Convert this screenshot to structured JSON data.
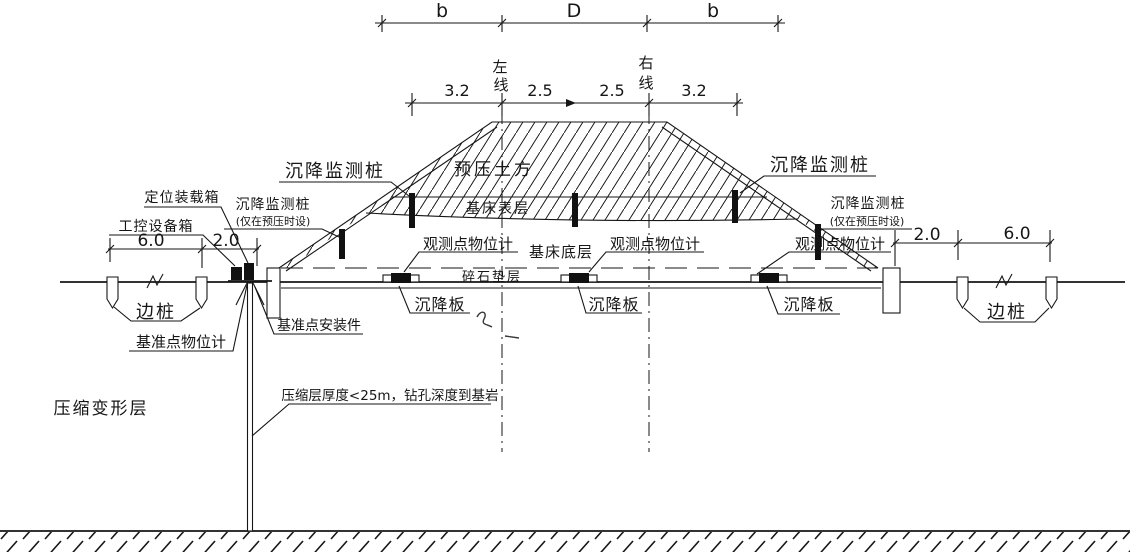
{
  "drawing": {
    "dimensions": {
      "top": {
        "b_left": "b",
        "d_center": "D",
        "b_right": "b"
      },
      "crown": {
        "v1": "3.2",
        "v2": "2.5",
        "v3": "2.5",
        "v4": "3.2"
      },
      "left_line": {
        "c1": "左",
        "c2": "线"
      },
      "right_line": {
        "c1": "右",
        "c2": "线"
      },
      "left_side": {
        "outer": "6.0",
        "inner": "2.0"
      },
      "right_side": {
        "inner": "2.0",
        "outer": "6.0"
      }
    },
    "labels": {
      "settlement_pile": "沉降监测桩",
      "settlement_pile_note": "(仅在预压时设)",
      "positioning_box": "定位装载箱",
      "control_box": "工控设备箱",
      "side_pile": "边桩",
      "benchmark_gauge": "基准点物位计",
      "benchmark_mount": "基准点安装件",
      "observation_gauge": "观测点物位计",
      "settlement_plate": "沉降板",
      "preload_fill": "预压土方",
      "bed_surface_layer": "基床表层",
      "bed_bottom_layer": "基床底层",
      "gravel_cushion": "碎石垫层",
      "compression_layer": "压缩变形层",
      "borehole_note": "压缩层厚度<25m，钻孔深度到基岩"
    },
    "colors": {
      "ink": "#161616",
      "paper": "#ffffff"
    }
  }
}
